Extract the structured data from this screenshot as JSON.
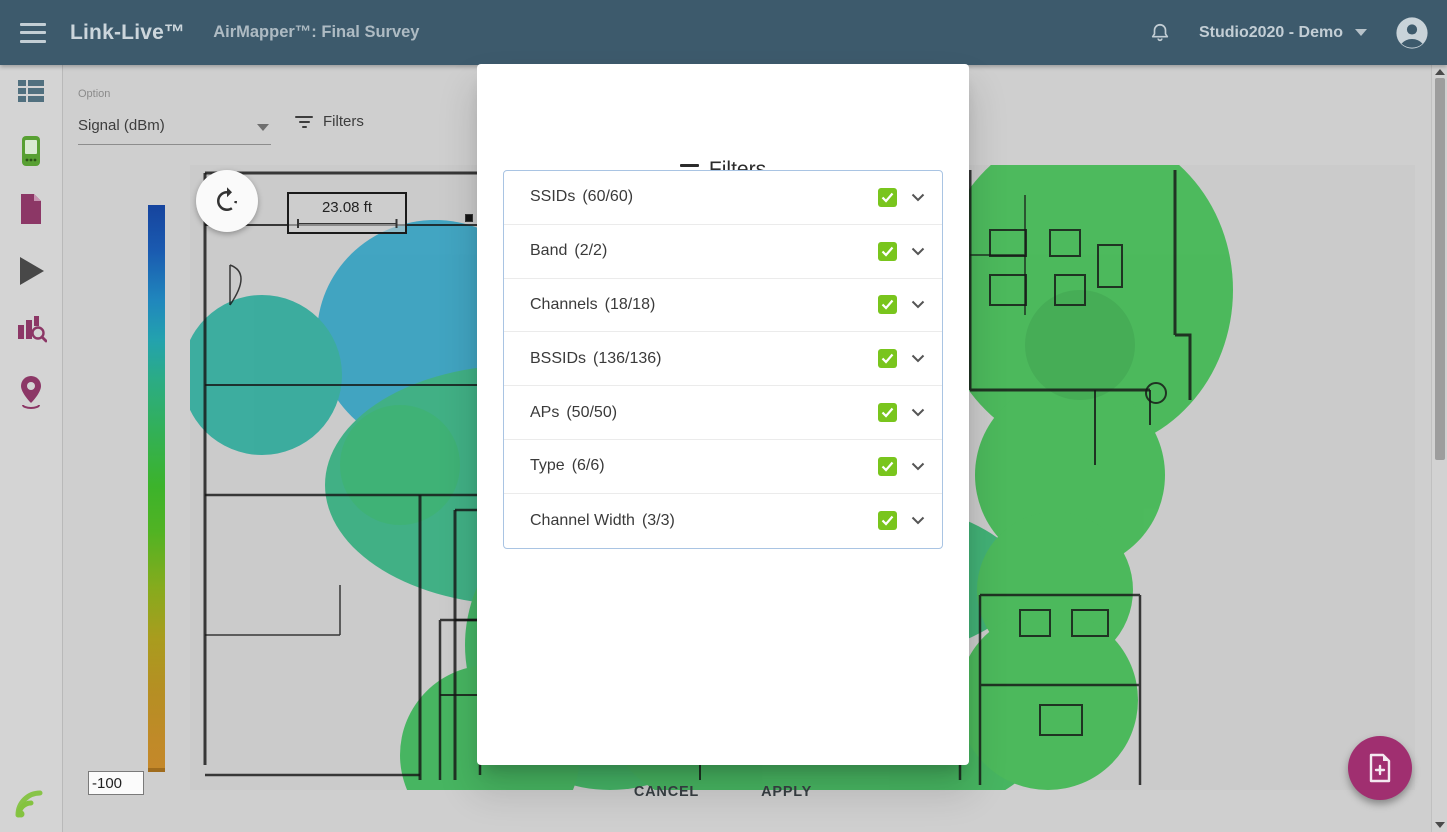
{
  "topbar": {
    "brand": "Link-Live™",
    "page_title": "AirMapper™: Final Survey",
    "account_name": "Studio2020 - Demo"
  },
  "sidebar": {
    "items": [
      {
        "name": "results-list"
      },
      {
        "name": "devices"
      },
      {
        "name": "documents"
      },
      {
        "name": "run-tests"
      },
      {
        "name": "analysis"
      },
      {
        "name": "airmapper-location"
      },
      {
        "name": "wifi-feed"
      }
    ]
  },
  "toolbar": {
    "option_label": "Option",
    "option_value": "Signal (dBm)",
    "filters_label": "Filters"
  },
  "legend": {
    "ticks": [
      "0",
      "-10",
      "-20",
      "-30",
      "-40",
      "-50",
      "-60",
      "-70",
      "-80",
      "-90",
      "-100"
    ],
    "min_input_value": "-100"
  },
  "map": {
    "scale_label": "23.08 ft"
  },
  "dialog": {
    "title": "Filters",
    "rows": [
      {
        "label": "SSIDs",
        "count": "(60/60)",
        "checked": true
      },
      {
        "label": "Band",
        "count": "(2/2)",
        "checked": true
      },
      {
        "label": "Channels",
        "count": "(18/18)",
        "checked": true
      },
      {
        "label": "BSSIDs",
        "count": "(136/136)",
        "checked": true
      },
      {
        "label": "APs",
        "count": "(50/50)",
        "checked": true
      },
      {
        "label": "Type",
        "count": "(6/6)",
        "checked": true
      },
      {
        "label": "Channel Width",
        "count": "(3/3)",
        "checked": true
      }
    ],
    "cancel_label": "CANCEL",
    "apply_label": "APPLY"
  },
  "colors": {
    "topbar_bg": "#3d5a6c",
    "checkbox_green": "#79c51d",
    "fab_purple": "#a02f70",
    "dialog_border": "#a9c4e3",
    "heat_blue": "#2f9fc0",
    "heat_teal": "#29a898",
    "heat_green": "#3bb74d",
    "scale_min": "#16449e",
    "scale_max": "#c4882a"
  }
}
